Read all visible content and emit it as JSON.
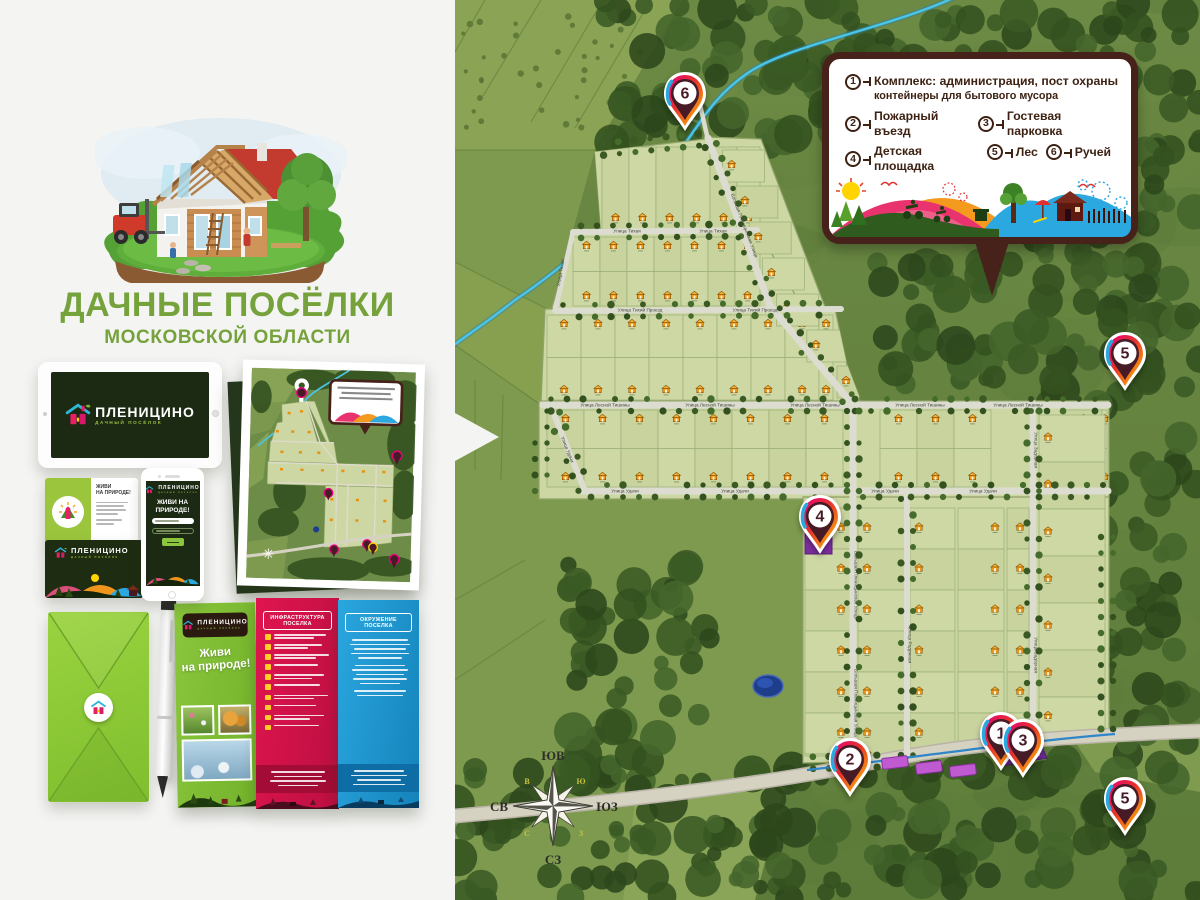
{
  "header": {
    "title_line1": "ДАЧНЫЕ ПОСЁЛКИ",
    "title_line2": "МОСКОВСКОЙ ОБЛАСТИ"
  },
  "brand": {
    "name": "ПЛЕНИЦИНО",
    "tagline": "ДАЧНЫЙ ПОСЁЛОК",
    "slogan_line1": "ЖИВИ НА",
    "slogan_line2": "ПРИРОДЕ!",
    "title_green": "#76a23c",
    "accent_green": "#8cc63e",
    "dark_green": "#1d2a13"
  },
  "card": {
    "headline_line1": "ЖИВИ",
    "headline_line2": "НА ПРИРОДЕ!"
  },
  "brochure": {
    "slogan_line1": "Живи",
    "slogan_line2": "на природе!",
    "panel_infra_title": "ИНФРАСТРУКТУРА ПОСЕЛКА",
    "panel_env_title": "ОКРУЖЕНИЕ ПОСЕЛКА"
  },
  "legend": {
    "items": [
      {
        "num": "1",
        "label": "Комплекс: администрация, пост охраны",
        "label2": "контейнеры для бытового мусора"
      },
      {
        "num": "2",
        "label": "Пожарный въезд"
      },
      {
        "num": "3",
        "label": "Гостевая парковка"
      },
      {
        "num": "4",
        "label": "Детская площадка"
      },
      {
        "num": "5",
        "label": "Лес"
      },
      {
        "num": "6",
        "label": "Ручей"
      }
    ]
  },
  "map": {
    "streets": {
      "lesnoy_tishiny": "Улица Лесной Тишины",
      "udachi": "Улица Удачи",
      "tikhaya": "Улица Тихая",
      "tikhiy_proezd": "Улица Тихий Проезд",
      "bolshaya_plenitsynskaya": "Большая Пленицынская Улица",
      "zadornaya": "Улица Задорная",
      "raduzhnaya": "Улица Радужная"
    },
    "pins": [
      {
        "num": "6",
        "x": 230,
        "y": 131
      },
      {
        "num": "5",
        "x": 670,
        "y": 391
      },
      {
        "num": "4",
        "x": 365,
        "y": 554
      },
      {
        "num": "2",
        "x": 395,
        "y": 797
      },
      {
        "num": "1",
        "x": 546,
        "y": 771
      },
      {
        "num": "3",
        "x": 568,
        "y": 778
      },
      {
        "num": "5",
        "x": 670,
        "y": 836
      }
    ],
    "compass": {
      "top": "ЮВ",
      "right": "ЮЗ",
      "bottom": "СЗ",
      "left": "СВ",
      "d_top_left": "В",
      "d_top_right": "Ю",
      "d_bottom_left": "С",
      "d_bottom_right": "З"
    },
    "plot_number_examples": [
      "91 / 1000",
      "90 / 1000",
      "74 / 1000",
      "73 / 1000",
      "139 / 965",
      "58 / 1206",
      "57 / 1188",
      "56 / 1167"
    ]
  }
}
